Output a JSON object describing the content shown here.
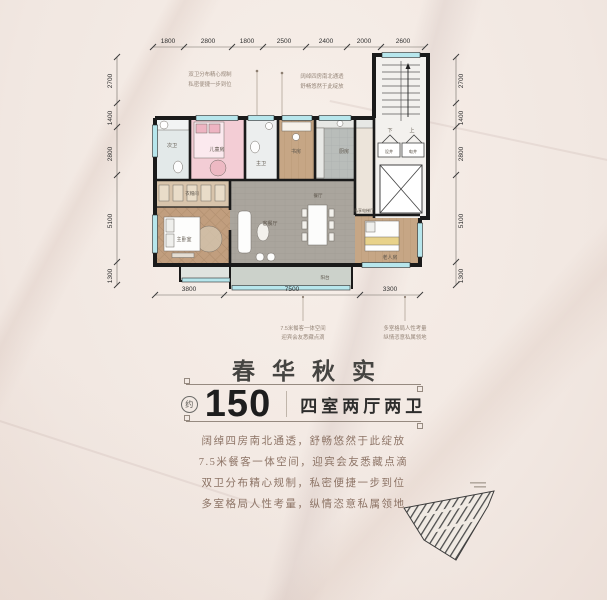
{
  "plan": {
    "dims_top": [
      "1800",
      "2800",
      "1800",
      "2500",
      "2400",
      "2000",
      "2600"
    ],
    "dims_left": [
      "2700",
      "1400",
      "2800",
      "5100",
      "1300"
    ],
    "dims_right": [
      "2700",
      "1400",
      "2800",
      "5100",
      "1300"
    ],
    "dims_bottom": [
      "3800",
      "7500",
      "3300"
    ],
    "rooms": {
      "bath2": "次卫",
      "kids": "儿童房",
      "bath1": "主卫",
      "study": "书房",
      "kitchen": "厨房",
      "closet": "衣帽间",
      "master": "主卧室",
      "living": "客餐厅",
      "dining": "餐厅",
      "elder": "老人房",
      "balcony": "阳台",
      "elevator_hall": "私享电梯厅",
      "shaft1": "设井",
      "shaft2": "电井",
      "stair_down": "下",
      "stair_up": "上"
    },
    "callouts": {
      "tl": [
        "双卫分布精心规制",
        "私密便捷一步到位"
      ],
      "tr": [
        "阔绰四房南北通透",
        "舒畅悠然于此绽放"
      ],
      "bl": [
        "7.5米餐客一体空间",
        "迎宾会友悉藏点滴"
      ],
      "br": [
        "多室格局人性考量",
        "纵情恣意私属领地"
      ]
    }
  },
  "info": {
    "title": "春华秋实",
    "approx": "约",
    "area": "150",
    "unit_type": "四室两厅两卫",
    "lines": [
      "阔绰四房南北通透，舒畅悠然于此绽放",
      "7.5米餐客一体空间，迎宾会友悉藏点滴",
      "双卫分布精心规制，私密便捷一步到位",
      "多室格局人性考量，纵情恣意私属领地"
    ]
  },
  "colors": {
    "wall": "#1a1a1a",
    "window": "#b7e6ec",
    "kids_room": "#f3cdd5",
    "wood": "#c6a685",
    "accent_text": "#8d7466"
  }
}
